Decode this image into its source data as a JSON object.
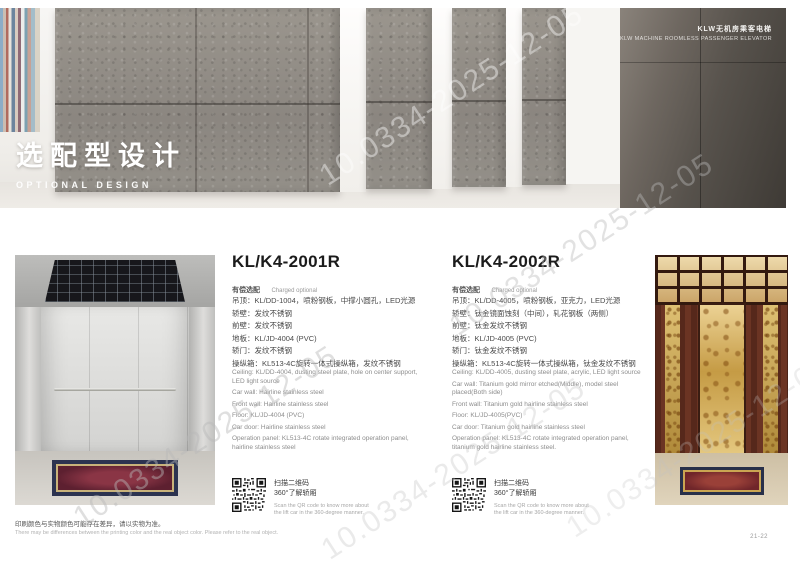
{
  "watermark": {
    "text": "10.0334-2025-12-05"
  },
  "hero": {
    "brand_line_zh": "KLW无机房乘客电梯",
    "brand_line_en": "KLW MACHINE ROOMLESS PASSENGER ELEVATOR",
    "title_zh": "选配型设计",
    "title_en": "OPTIONAL DESIGN"
  },
  "products": [
    {
      "model": "KL/K4-2001R",
      "pricing_zh": "有偿选配",
      "pricing_en": "Charged optional",
      "specs_zh": [
        "吊顶：KL/DD-1004，喷粉钢板，中撑小圆孔，LED光源",
        "轿壁：发纹不锈钢",
        "前壁：发纹不锈钢",
        "地板：KL/JD-4004 (PVC)",
        "轿门：发纹不锈钢",
        "操纵箱：KL513-4C旋转一体式操纵箱，发纹不锈钢"
      ],
      "specs_en": [
        "Ceiling: KL/DD-4004, dusting steel plate, hole on center support, LED light source",
        "Car wall: Hairline stainless steel",
        "Front wall: Hairline stainless steel",
        "Floor: KL/JD-4004 (PVC)",
        "Car door: Hairline stainless steel",
        "Operation panel: KL513-4C rotate integrated operation panel, hairline stainless steel"
      ],
      "qr_caption_zh_1": "扫描二维码",
      "qr_caption_zh_2": "360°了解轿厢",
      "qr_caption_en_1": "Scan the QR code to know more about",
      "qr_caption_en_2": "the lift car in the 360-degree manner."
    },
    {
      "model": "KL/K4-2002R",
      "pricing_zh": "有偿选配",
      "pricing_en": "Charged optional",
      "specs_zh": [
        "吊顶：KL/DD-4005，喷粉钢板，亚克力，LED光源",
        "轿壁：钛金镜面蚀刻（中间），轧花钢板（两侧）",
        "前壁：钛金发纹不锈钢",
        "地板：KL/JD-4005 (PVC)",
        "轿门：钛金发纹不锈钢",
        "操纵箱：KL513-4C旋转一体式操纵箱，钛金发纹不锈钢"
      ],
      "specs_en": [
        "Ceiling: KL/DD-4005, dusting steel plate, acrylic, LED light source",
        "Car wall: Titanium gold mirror etched(Middle), model steel placed(Both side)",
        "Front wall: Titanium gold hairline stainless steel",
        "Floor: KL/JD-4005(PVC)",
        "Car door: Titanium gold hairline stainless steel",
        "Operation panel: KL513-4C rotate integrated operation panel, titanium gold hairline stainless steel."
      ],
      "qr_caption_zh_1": "扫描二维码",
      "qr_caption_zh_2": "360°了解轿厢",
      "qr_caption_en_1": "Scan the QR code to know more about",
      "qr_caption_en_2": "the lift car in the 360-degree manner."
    }
  ],
  "footer": {
    "note_zh": "印刷颜色与实物颜色可能存在差异，请以实物为准。",
    "note_en": "There may be differences between the printing color and the real object color. Please refer to the real object.",
    "page_number": "21-22"
  },
  "colors": {
    "concrete": "#938e86",
    "dark_panel": "#4a453f",
    "steel_car": "#d6d5d2",
    "rosewood_car": "#5e2f1f",
    "gold_accent": "#caa14e"
  }
}
